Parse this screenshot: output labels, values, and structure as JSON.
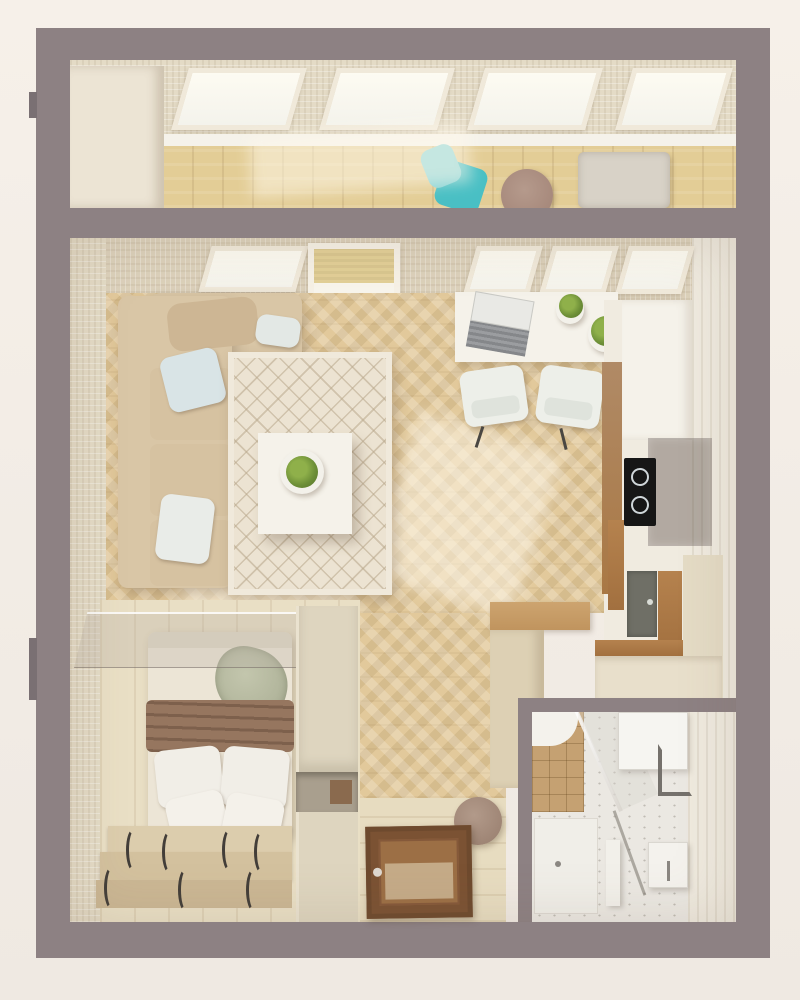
{
  "scene": {
    "title": "Studio apartment — 3D floor plan, top-down view",
    "type": "architectural-render",
    "view": "top-down"
  },
  "palette": {
    "background": "#f2ece5",
    "outer_walls": "#8d8183",
    "inner_walls": "#dcd1bb",
    "herringbone_floor": "#e2c99b",
    "balcony_floor": "#e3cd96",
    "sofa": "#d9c6a6",
    "rug": "#ece3d2",
    "accent_teal": "#49bfc4",
    "bed_blanket": "#96765f",
    "wardrobe": "#ded5bf",
    "entrance_door": "#8a5f3a",
    "cooktop": "#161616",
    "shower_tiles": "#c5a172",
    "plant_green": "#6d8f37"
  },
  "rooms": {
    "balcony": {
      "label": "Balcony",
      "furniture": [
        "teal lounge chair",
        "round side table",
        "storage ottoman",
        "cabinet",
        "glazed window band"
      ]
    },
    "living_room": {
      "label": "Living room",
      "furniture": [
        "corner sofa",
        "blue pillow",
        "white pillow",
        "quilted rug",
        "white coffee table",
        "potted plant"
      ]
    },
    "work_area": {
      "label": "Desk / dining area",
      "furniture": [
        "white desk",
        "laptop",
        "two potted plants",
        "two white chairs"
      ]
    },
    "kitchen": {
      "label": "Kitchen",
      "furniture": [
        "induction cooktop",
        "smoked glass panel",
        "sink",
        "wood trim counters",
        "stone counters"
      ]
    },
    "bedroom": {
      "label": "Bedroom",
      "furniture": [
        "double bed",
        "brown blanket",
        "four white pillows",
        "green throw",
        "podium drawers with handles",
        "glass partition",
        "wardrobe"
      ]
    },
    "hallway": {
      "label": "Hallway / entry",
      "furniture": [
        "entrance door",
        "round pouf",
        "entry cabinet"
      ]
    },
    "bathroom": {
      "label": "Bathroom",
      "furniture": [
        "tiled shower",
        "glass screen",
        "washing machine",
        "corner shelf",
        "washbasin",
        "partition"
      ]
    }
  }
}
